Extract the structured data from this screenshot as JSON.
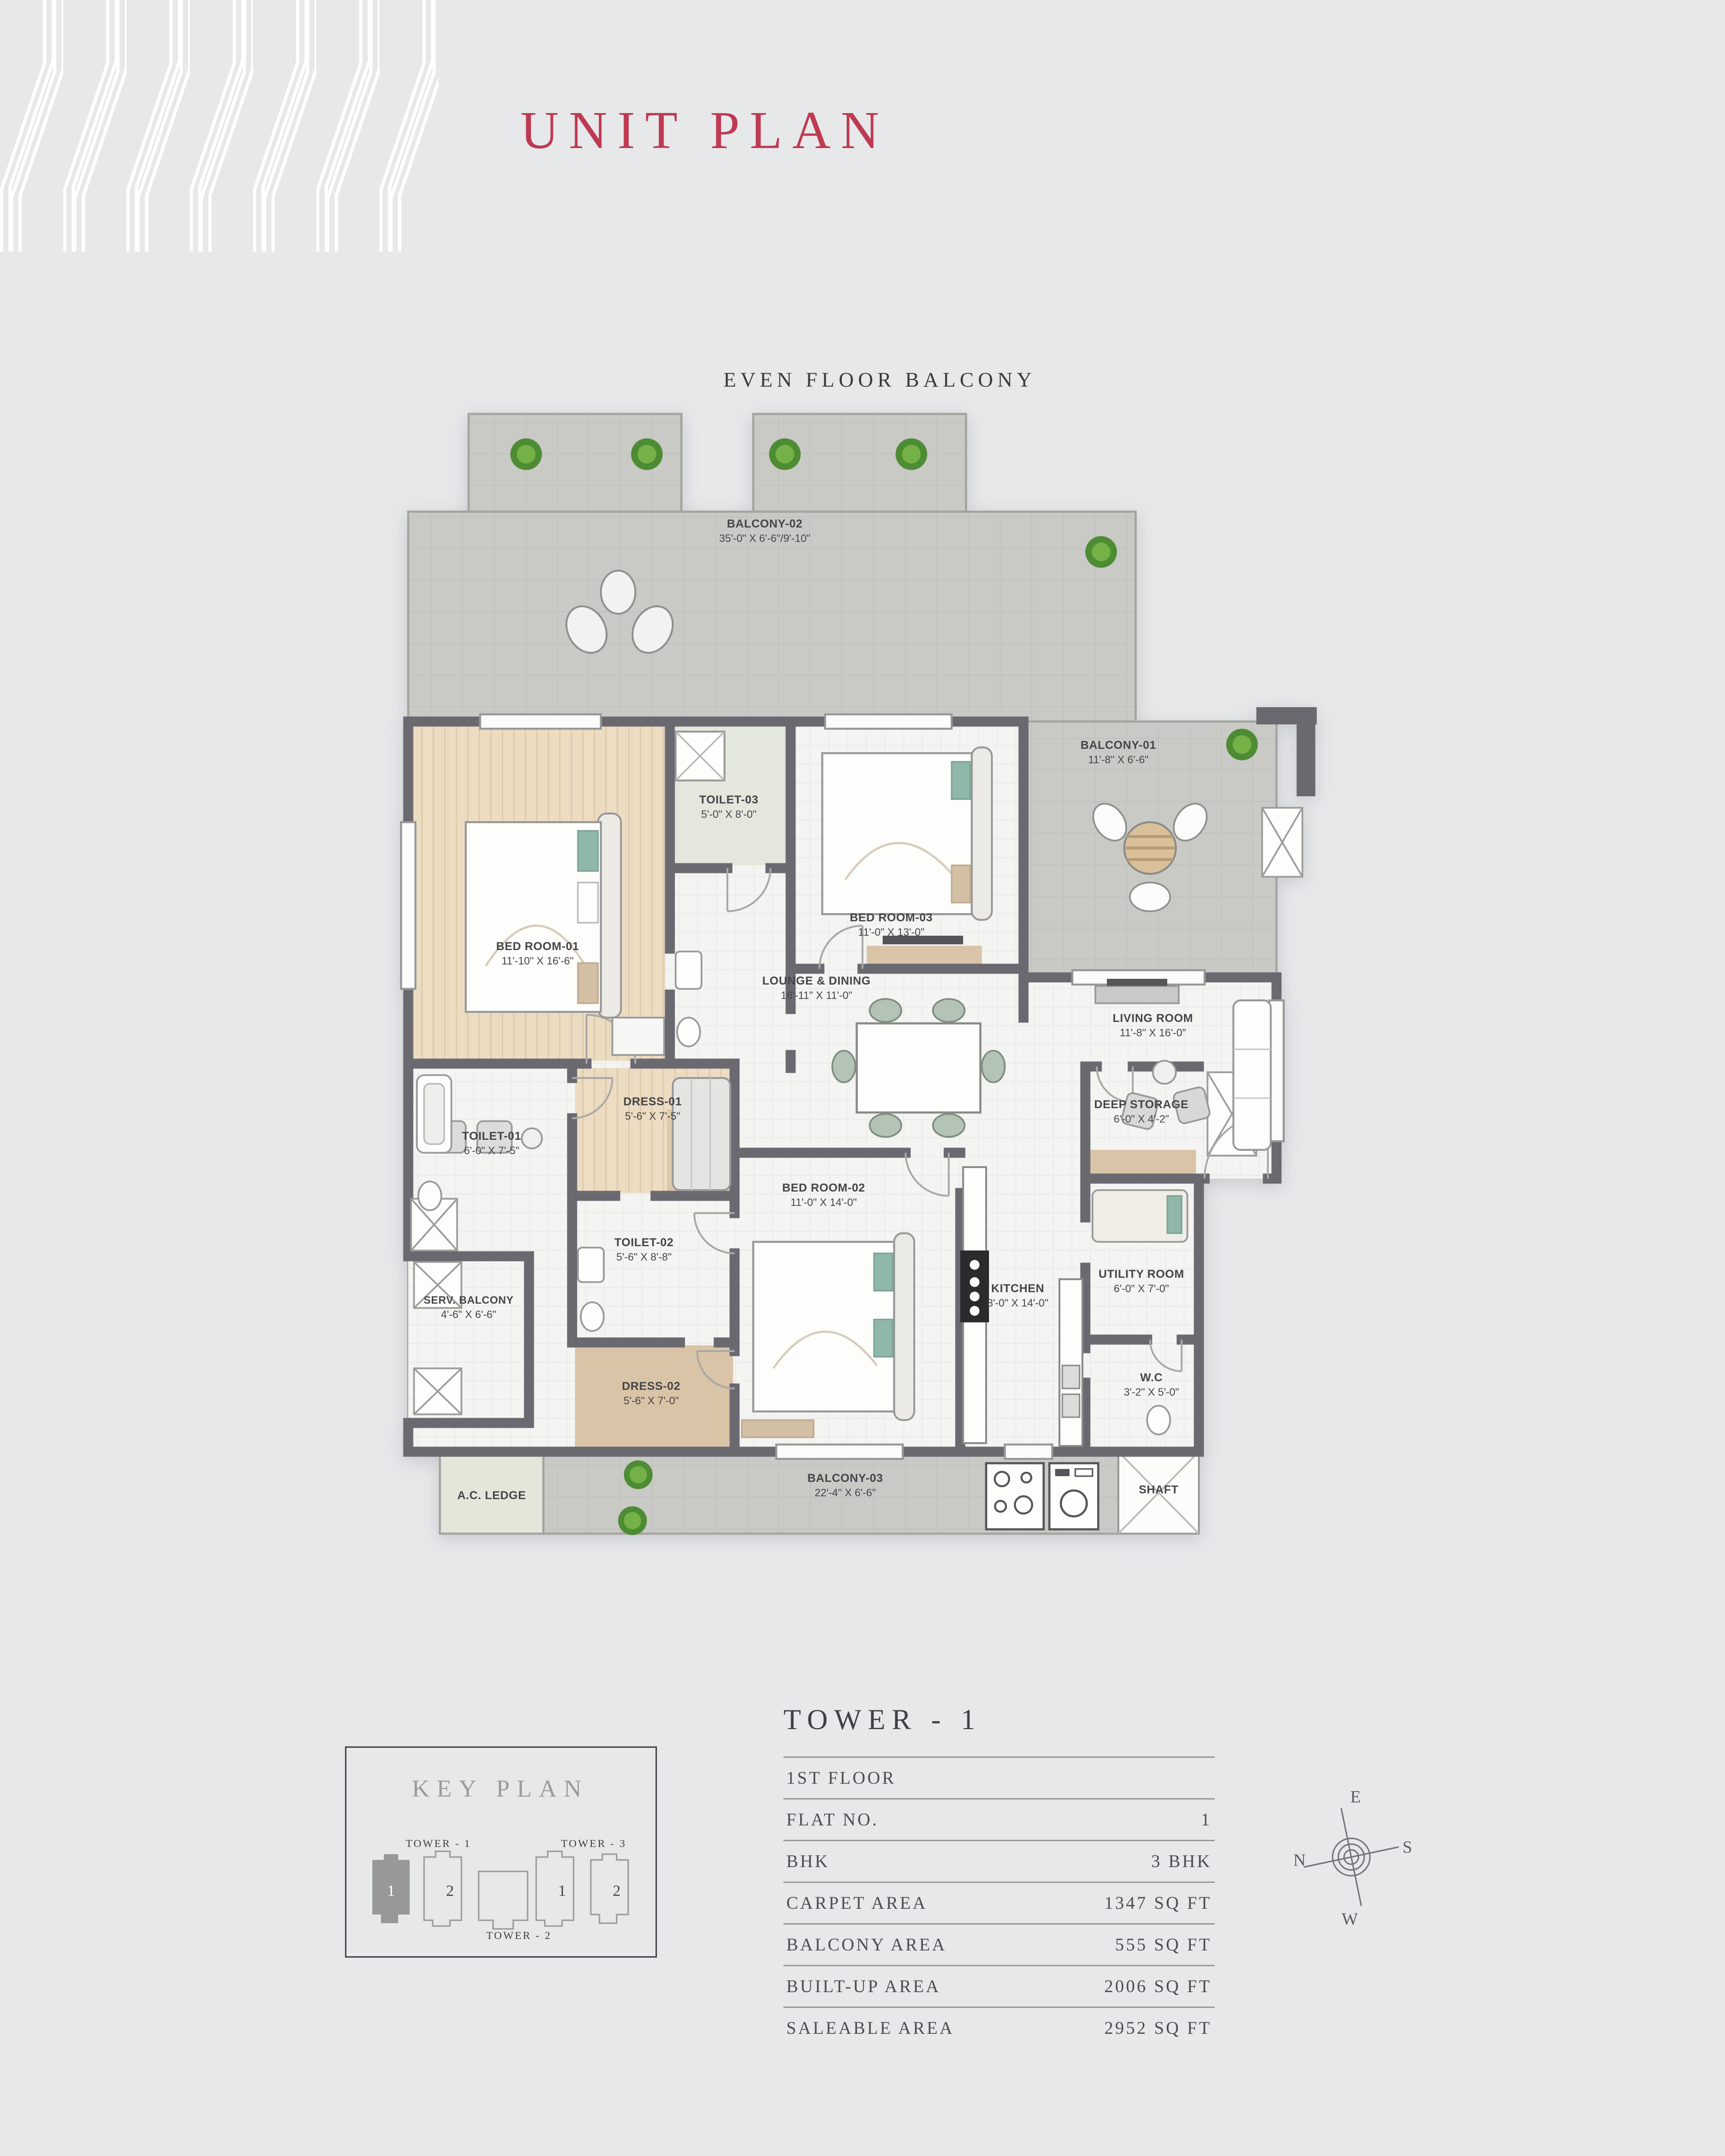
{
  "colors": {
    "background": "#e7e8ea",
    "accent_red": "#be3a52",
    "wall": "#6b6970",
    "concrete": "#c9c9c6",
    "wood": "#ecdcc2",
    "tan": "#d9c4a7",
    "teal": "#8fb8ab",
    "sage": "#b3c4b6",
    "plant_green": "#57923a",
    "label_text": "#45454a",
    "line_gray": "#9b9b9d"
  },
  "header": {
    "title": "UNIT PLAN"
  },
  "plan_header": "EVEN FLOOR BALCONY",
  "plan": {
    "rooms": [
      {
        "name": "BALCONY-02",
        "dims": "35'-0\" X 6'-6\"/9'-10\""
      },
      {
        "name": "BALCONY-01",
        "dims": "11'-8\" X 6'-6\""
      },
      {
        "name": "TOILET-03",
        "dims": "5'-0\" X 8'-0\""
      },
      {
        "name": "BED ROOM-03",
        "dims": "11'-0\" X 13'-0\""
      },
      {
        "name": "BED ROOM-01",
        "dims": "11'-10\" X 16'-6\""
      },
      {
        "name": "LOUNGE & DINING",
        "dims": "16'-11\" X 11'-0\""
      },
      {
        "name": "LIVING ROOM",
        "dims": "11'-8\" X 16'-0\""
      },
      {
        "name": "DRESS-01",
        "dims": "5'-6\" X 7'-5\""
      },
      {
        "name": "TOILET-01",
        "dims": "6'-0\" X 7'-5\""
      },
      {
        "name": "SERV. BALCONY",
        "dims": "4'-6\" X 6'-6\""
      },
      {
        "name": "TOILET-02",
        "dims": "5'-6\" X 8'-8\""
      },
      {
        "name": "BED ROOM-02",
        "dims": "11'-0\" X 14'-0\""
      },
      {
        "name": "KITCHEN",
        "dims": "8'-0\" X 14'-0\""
      },
      {
        "name": "DEEP STORAGE",
        "dims": "6'-0\" X 4'-2\""
      },
      {
        "name": "UTILITY ROOM",
        "dims": "6'-0\" X 7'-0\""
      },
      {
        "name": "DRESS-02",
        "dims": "5'-6\" X 7'-0\""
      },
      {
        "name": "W.C",
        "dims": "3'-2\" X 5'-0\""
      },
      {
        "name": "BALCONY-03",
        "dims": "22'-4\" X 6'-6\""
      },
      {
        "name": "A.C. LEDGE",
        "dims": ""
      },
      {
        "name": "SHAFT",
        "dims": ""
      }
    ]
  },
  "key_plan": {
    "title": "KEY PLAN",
    "towers": [
      {
        "label": "TOWER - 1"
      },
      {
        "label": "TOWER - 2"
      },
      {
        "label": "TOWER - 3"
      }
    ],
    "units": [
      "1",
      "2",
      "1",
      "2"
    ]
  },
  "spec_table": {
    "header": "TOWER - 1",
    "rows": [
      {
        "label": "1ST FLOOR",
        "value": ""
      },
      {
        "label": "FLAT NO.",
        "value": "1"
      },
      {
        "label": "BHK",
        "value": "3 BHK"
      },
      {
        "label": "CARPET AREA",
        "value": "1347 SQ FT"
      },
      {
        "label": "BALCONY AREA",
        "value": "555 SQ FT"
      },
      {
        "label": "BUILT-UP AREA",
        "value": "2006 SQ FT"
      },
      {
        "label": "SALEABLE AREA",
        "value": "2952 SQ FT"
      }
    ]
  },
  "compass": {
    "top": "E",
    "right": "S",
    "left": "N",
    "bottom": "W"
  }
}
